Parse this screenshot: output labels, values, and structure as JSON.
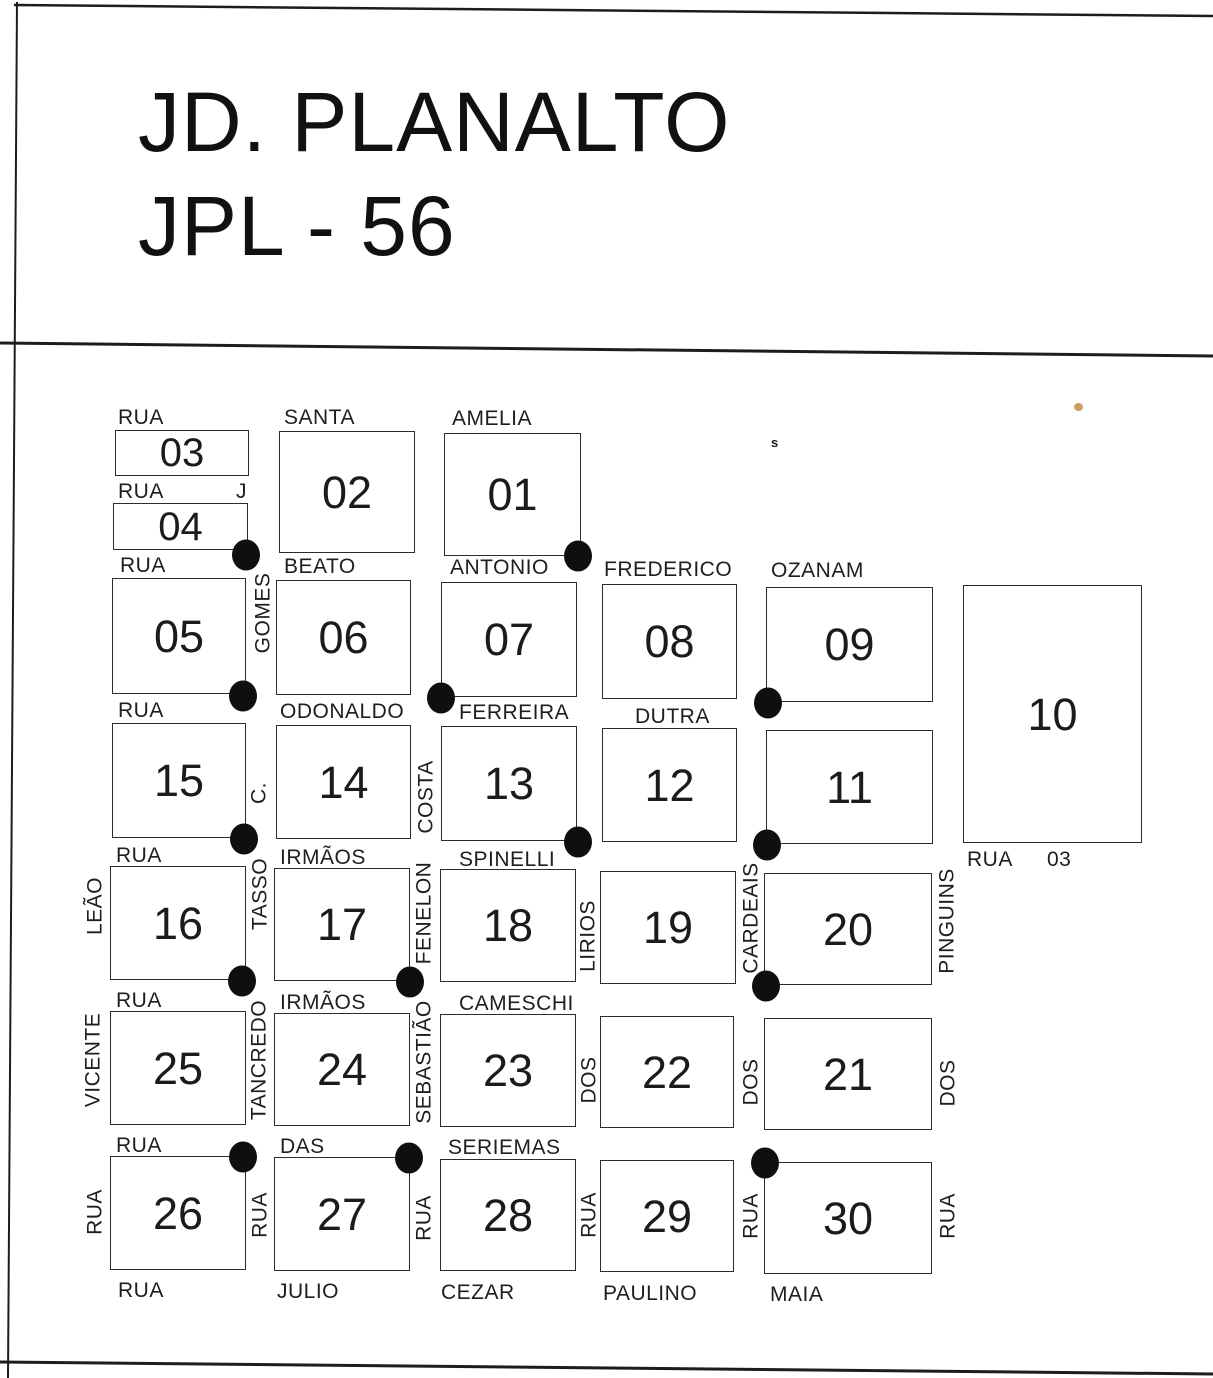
{
  "title": {
    "line1": "JD. PLANALTO",
    "line2": "JPL - 56"
  },
  "colors": {
    "ink": "#1c1c1c",
    "paper": "#ffffff",
    "dot": "#0f0f0f",
    "artifact_tan": "#c9a05e"
  },
  "map": {
    "blocks": [
      {
        "num": "03",
        "x": 115,
        "y": 430,
        "w": 134,
        "h": 46,
        "fs": 40
      },
      {
        "num": "04",
        "x": 113,
        "y": 503,
        "w": 135,
        "h": 47,
        "fs": 40
      },
      {
        "num": "02",
        "x": 279,
        "y": 431,
        "w": 136,
        "h": 122,
        "fs": 45
      },
      {
        "num": "01",
        "x": 444,
        "y": 433,
        "w": 137,
        "h": 123,
        "fs": 45
      },
      {
        "num": "05",
        "x": 112,
        "y": 578,
        "w": 134,
        "h": 116,
        "fs": 45
      },
      {
        "num": "06",
        "x": 276,
        "y": 580,
        "w": 135,
        "h": 115,
        "fs": 45
      },
      {
        "num": "07",
        "x": 441,
        "y": 582,
        "w": 136,
        "h": 115,
        "fs": 45
      },
      {
        "num": "08",
        "x": 602,
        "y": 584,
        "w": 135,
        "h": 115,
        "fs": 45
      },
      {
        "num": "09",
        "x": 766,
        "y": 587,
        "w": 167,
        "h": 115,
        "fs": 45
      },
      {
        "num": "10",
        "x": 963,
        "y": 585,
        "w": 179,
        "h": 258,
        "fs": 45
      },
      {
        "num": "15",
        "x": 112,
        "y": 723,
        "w": 134,
        "h": 115,
        "fs": 45
      },
      {
        "num": "14",
        "x": 276,
        "y": 725,
        "w": 135,
        "h": 114,
        "fs": 45
      },
      {
        "num": "13",
        "x": 441,
        "y": 726,
        "w": 136,
        "h": 115,
        "fs": 45
      },
      {
        "num": "12",
        "x": 602,
        "y": 728,
        "w": 135,
        "h": 114,
        "fs": 45
      },
      {
        "num": "11",
        "x": 766,
        "y": 730,
        "w": 167,
        "h": 114,
        "fs": 45
      },
      {
        "num": "16",
        "x": 110,
        "y": 866,
        "w": 136,
        "h": 114,
        "fs": 45
      },
      {
        "num": "17",
        "x": 274,
        "y": 868,
        "w": 136,
        "h": 113,
        "fs": 45
      },
      {
        "num": "18",
        "x": 440,
        "y": 869,
        "w": 136,
        "h": 113,
        "fs": 45
      },
      {
        "num": "19",
        "x": 600,
        "y": 871,
        "w": 136,
        "h": 113,
        "fs": 45
      },
      {
        "num": "20",
        "x": 764,
        "y": 873,
        "w": 168,
        "h": 112,
        "fs": 45
      },
      {
        "num": "25",
        "x": 110,
        "y": 1011,
        "w": 136,
        "h": 114,
        "fs": 45
      },
      {
        "num": "24",
        "x": 274,
        "y": 1013,
        "w": 136,
        "h": 113,
        "fs": 45
      },
      {
        "num": "23",
        "x": 440,
        "y": 1014,
        "w": 136,
        "h": 113,
        "fs": 45
      },
      {
        "num": "22",
        "x": 600,
        "y": 1016,
        "w": 134,
        "h": 112,
        "fs": 45
      },
      {
        "num": "21",
        "x": 764,
        "y": 1018,
        "w": 168,
        "h": 112,
        "fs": 45
      },
      {
        "num": "26",
        "x": 110,
        "y": 1156,
        "w": 136,
        "h": 114,
        "fs": 45
      },
      {
        "num": "27",
        "x": 274,
        "y": 1157,
        "w": 136,
        "h": 114,
        "fs": 45
      },
      {
        "num": "28",
        "x": 440,
        "y": 1159,
        "w": 136,
        "h": 112,
        "fs": 45
      },
      {
        "num": "29",
        "x": 600,
        "y": 1160,
        "w": 134,
        "h": 112,
        "fs": 45
      },
      {
        "num": "30",
        "x": 764,
        "y": 1162,
        "w": 168,
        "h": 112,
        "fs": 45
      }
    ],
    "h_labels": [
      {
        "text": "RUA",
        "x": 118,
        "y": 407
      },
      {
        "text": "SANTA",
        "x": 284,
        "y": 407
      },
      {
        "text": "AMELIA",
        "x": 452,
        "y": 408
      },
      {
        "text": "RUA",
        "x": 118,
        "y": 481
      },
      {
        "text": "J",
        "x": 236,
        "y": 481
      },
      {
        "text": "RUA",
        "x": 120,
        "y": 555
      },
      {
        "text": "BEATO",
        "x": 284,
        "y": 556
      },
      {
        "text": "ANTONIO",
        "x": 450,
        "y": 557
      },
      {
        "text": "FREDERICO",
        "x": 604,
        "y": 559
      },
      {
        "text": "OZANAM",
        "x": 771,
        "y": 560
      },
      {
        "text": "RUA",
        "x": 118,
        "y": 700
      },
      {
        "text": "ODONALDO",
        "x": 280,
        "y": 701
      },
      {
        "text": "FERREIRA",
        "x": 459,
        "y": 702
      },
      {
        "text": "DUTRA",
        "x": 635,
        "y": 706
      },
      {
        "text": "RUA",
        "x": 116,
        "y": 845
      },
      {
        "text": "IRMÃOS",
        "x": 280,
        "y": 847
      },
      {
        "text": "SPINELLI",
        "x": 459,
        "y": 849
      },
      {
        "text": "RUA",
        "x": 967,
        "y": 849
      },
      {
        "text": "03",
        "x": 1047,
        "y": 849
      },
      {
        "text": "RUA",
        "x": 116,
        "y": 990
      },
      {
        "text": "IRMÃOS",
        "x": 280,
        "y": 992
      },
      {
        "text": "CAMESCHI",
        "x": 459,
        "y": 993
      },
      {
        "text": "RUA",
        "x": 116,
        "y": 1135
      },
      {
        "text": "DAS",
        "x": 280,
        "y": 1136
      },
      {
        "text": "SERIEMAS",
        "x": 448,
        "y": 1137
      },
      {
        "text": "RUA",
        "x": 118,
        "y": 1280
      },
      {
        "text": "JULIO",
        "x": 277,
        "y": 1281
      },
      {
        "text": "CEZAR",
        "x": 441,
        "y": 1282
      },
      {
        "text": "PAULINO",
        "x": 603,
        "y": 1283
      },
      {
        "text": "MAIA",
        "x": 770,
        "y": 1284
      }
    ],
    "v_labels": [
      {
        "text": "GOMES",
        "cx": 263,
        "cy": 613
      },
      {
        "text": "C.",
        "cx": 259,
        "cy": 793
      },
      {
        "text": "COSTA",
        "cx": 426,
        "cy": 797
      },
      {
        "text": "LEÃO",
        "cx": 95,
        "cy": 906
      },
      {
        "text": "TASSO",
        "cx": 260,
        "cy": 894
      },
      {
        "text": "FENELON",
        "cx": 424,
        "cy": 913
      },
      {
        "text": "LIRIOS",
        "cx": 588,
        "cy": 936
      },
      {
        "text": "CARDEAIS",
        "cx": 751,
        "cy": 918
      },
      {
        "text": "PINGUINS",
        "cx": 947,
        "cy": 921
      },
      {
        "text": "VICENTE",
        "cx": 93,
        "cy": 1060
      },
      {
        "text": "TANCREDO",
        "cx": 259,
        "cy": 1060
      },
      {
        "text": "SEBASTIÃO",
        "cx": 424,
        "cy": 1062
      },
      {
        "text": "DOS",
        "cx": 589,
        "cy": 1080
      },
      {
        "text": "DOS",
        "cx": 751,
        "cy": 1082
      },
      {
        "text": "DOS",
        "cx": 948,
        "cy": 1083
      },
      {
        "text": "RUA",
        "cx": 95,
        "cy": 1212
      },
      {
        "text": "RUA",
        "cx": 260,
        "cy": 1215
      },
      {
        "text": "RUA",
        "cx": 424,
        "cy": 1218
      },
      {
        "text": "RUA",
        "cx": 589,
        "cy": 1215
      },
      {
        "text": "RUA",
        "cx": 751,
        "cy": 1216
      },
      {
        "text": "RUA",
        "cx": 948,
        "cy": 1216
      }
    ],
    "dots": [
      {
        "cx": 246,
        "cy": 555
      },
      {
        "cx": 578,
        "cy": 556
      },
      {
        "cx": 243,
        "cy": 696
      },
      {
        "cx": 441,
        "cy": 698
      },
      {
        "cx": 768,
        "cy": 703
      },
      {
        "cx": 244,
        "cy": 839
      },
      {
        "cx": 578,
        "cy": 842
      },
      {
        "cx": 767,
        "cy": 845
      },
      {
        "cx": 242,
        "cy": 981
      },
      {
        "cx": 410,
        "cy": 982
      },
      {
        "cx": 766,
        "cy": 986
      },
      {
        "cx": 243,
        "cy": 1157
      },
      {
        "cx": 409,
        "cy": 1158
      },
      {
        "cx": 765,
        "cy": 1163
      }
    ],
    "artifacts": [
      {
        "type": "speck",
        "text": "s",
        "x": 771,
        "y": 436
      },
      {
        "type": "tan",
        "x": 1074,
        "y": 403
      }
    ],
    "border_lines": [
      {
        "name": "top-border-line",
        "x1": 14,
        "y1": 5,
        "x2": 1213,
        "y2": 16,
        "w": 2.5
      },
      {
        "name": "left-border-line",
        "x1": 17,
        "y1": 2,
        "x2": 8,
        "y2": 1378,
        "w": 2
      },
      {
        "name": "title-divider-line",
        "x1": 0,
        "y1": 343,
        "x2": 1213,
        "y2": 356,
        "w": 3
      },
      {
        "name": "bottom-border-line",
        "x1": 0,
        "y1": 1362,
        "x2": 1213,
        "y2": 1374,
        "w": 3
      }
    ]
  }
}
